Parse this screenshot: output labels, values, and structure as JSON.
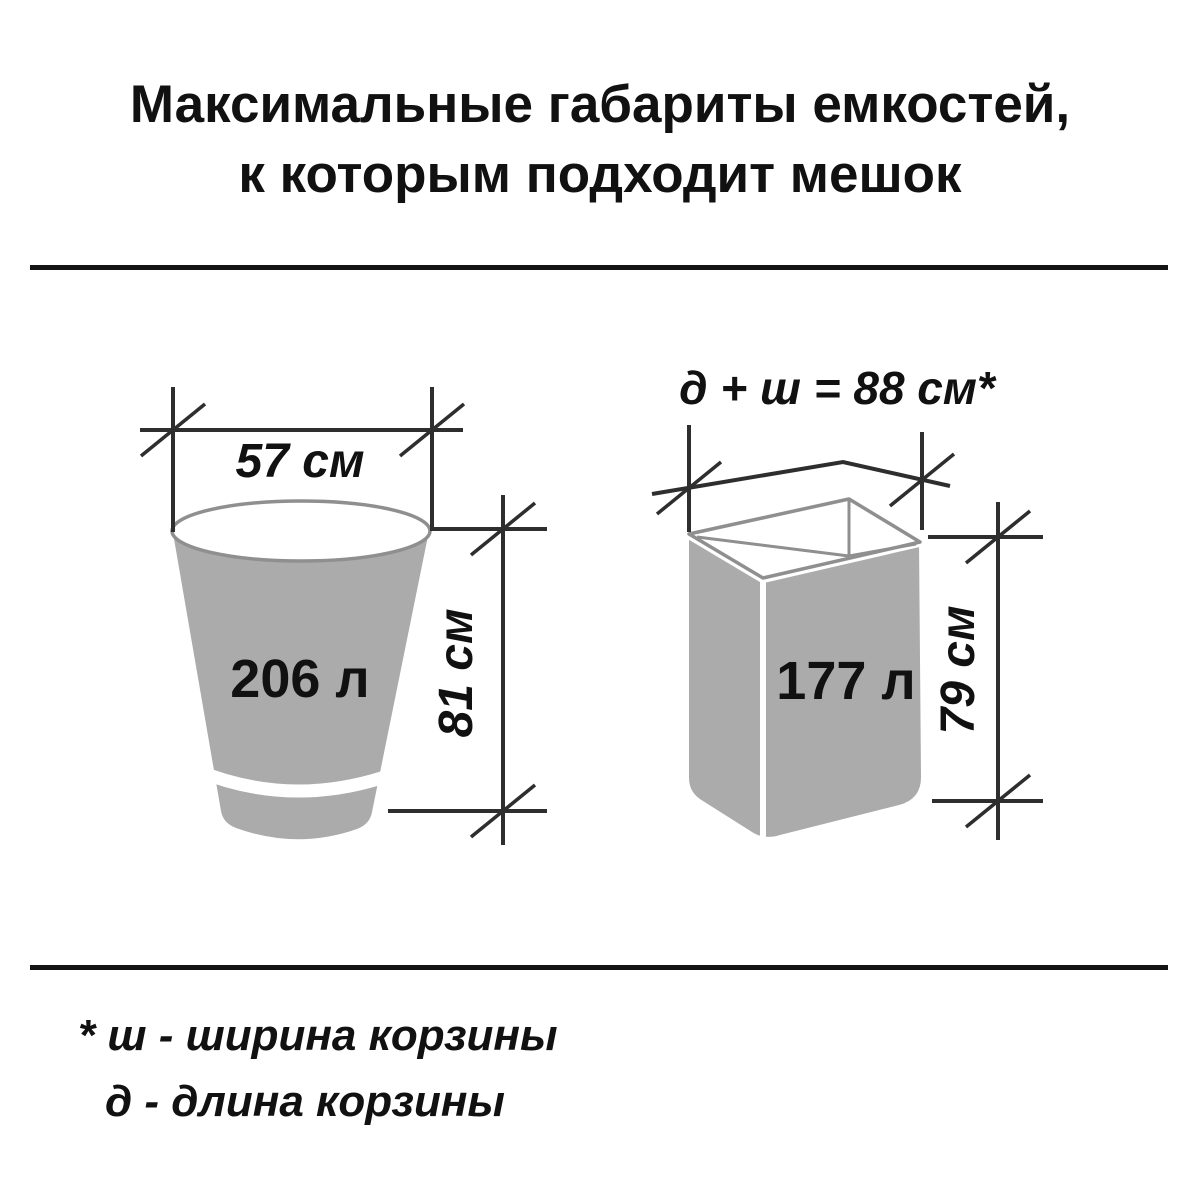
{
  "title": {
    "line1": "Максимальные габариты емкостей,",
    "line2": "к которым подходит мешок"
  },
  "bucket_diagram": {
    "shape": "round-tapered-bucket",
    "width_label": "57 см",
    "volume_label": "206 л",
    "height_label": "81 см"
  },
  "basket_diagram": {
    "shape": "rectangular-open-basket",
    "formula_label": "д + ш = 88 см*",
    "volume_label": "177 л",
    "height_label": "79 см"
  },
  "footnote": {
    "line1": "* ш - ширина корзины",
    "line2": "д - длина корзины"
  },
  "colors": {
    "background": "#ffffff",
    "container_fill": "#ababab",
    "container_stroke": "#8f8f8f",
    "dimension_line": "#2e2e2e",
    "text": "#111111",
    "divider": "#141414"
  }
}
